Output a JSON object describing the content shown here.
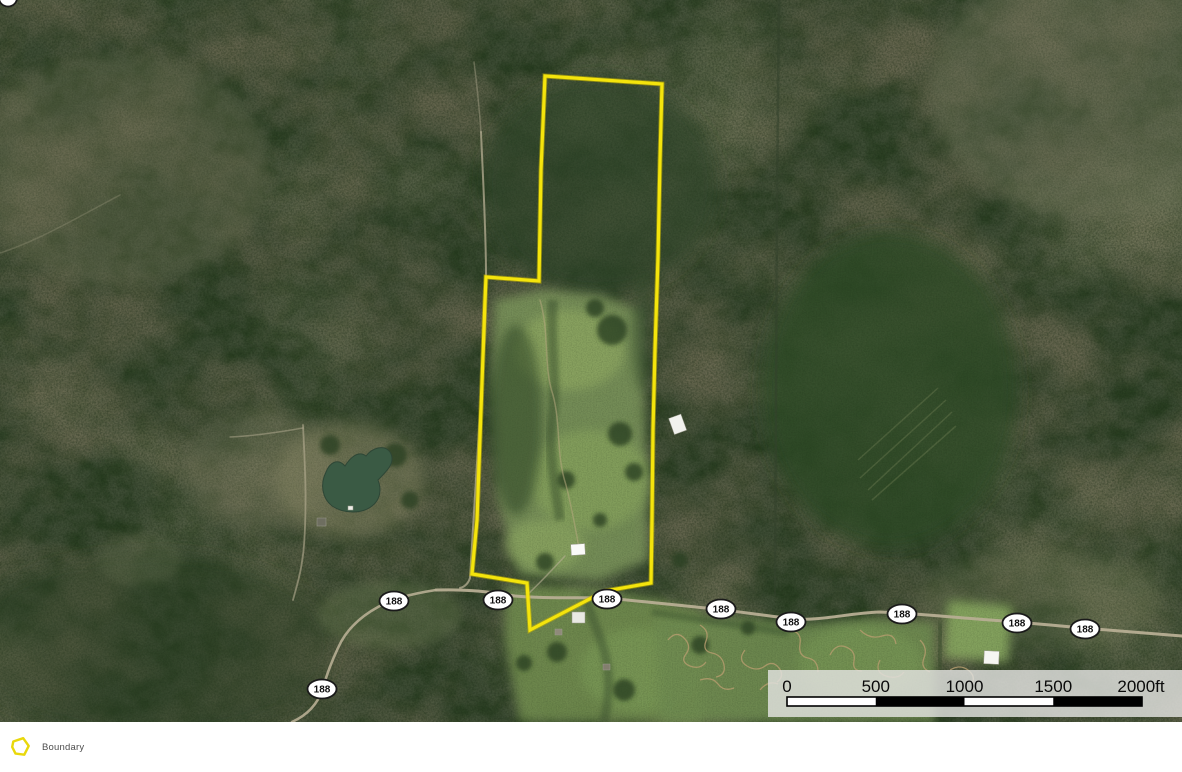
{
  "map": {
    "type": "satellite-imagery",
    "boundary": {
      "label": "Boundary",
      "color": "#f4e40c",
      "under_color": "#c9b700",
      "points": "545,76 662,84 660,160 658,257 655,350 653,430 652,520 651,583 605,591 530,630 527,583 472,574 477,520 485,300 486,277 539,281 541,170"
    },
    "road_shields": [
      {
        "label": "188"
      },
      {
        "label": "188"
      },
      {
        "label": "188"
      },
      {
        "label": "188"
      },
      {
        "label": "188"
      },
      {
        "label": "188"
      },
      {
        "label": "188"
      },
      {
        "label": "188"
      },
      {
        "label": "188"
      }
    ],
    "scale_bar": {
      "unit": "ft",
      "values": [
        0,
        500,
        1000,
        1500,
        2000
      ],
      "labels": [
        "0",
        "500",
        "1000",
        "1500",
        "2000ft"
      ]
    }
  },
  "legend": {
    "items": [
      {
        "label": "Boundary",
        "swatch_color": "#e9d80b"
      }
    ]
  }
}
